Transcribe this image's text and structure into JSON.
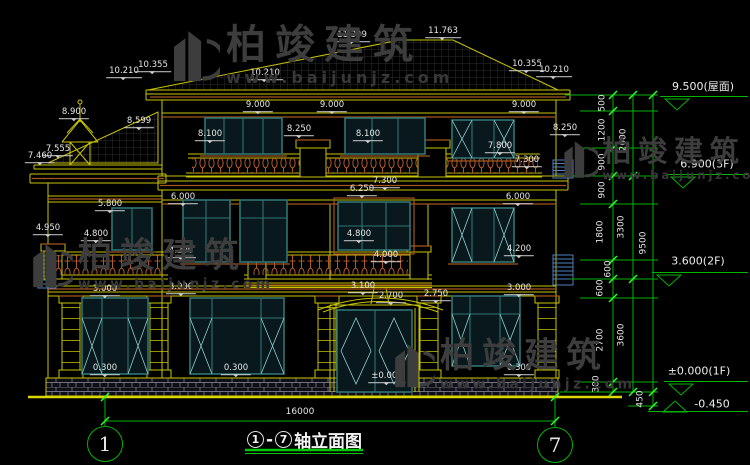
{
  "title_block": {
    "axis_start": "1",
    "separator": "-",
    "axis_end": "7",
    "title_text": "轴立面图",
    "span_dim": "16000"
  },
  "axis_bubbles": [
    {
      "label": "1",
      "x": 105,
      "y": 444
    },
    {
      "label": "7",
      "x": 555,
      "y": 445
    }
  ],
  "dim_labels": [
    {
      "t": "11.763",
      "x": 443,
      "y": 33
    },
    {
      "t": "11.399",
      "x": 352,
      "y": 37
    },
    {
      "t": "10.210",
      "x": 124,
      "y": 73
    },
    {
      "t": "10.355",
      "x": 153,
      "y": 67
    },
    {
      "t": "10.210",
      "x": 265,
      "y": 75
    },
    {
      "t": "10.355",
      "x": 527,
      "y": 66
    },
    {
      "t": "10.210",
      "x": 554,
      "y": 72
    },
    {
      "t": "8.900",
      "x": 74,
      "y": 114
    },
    {
      "t": "8.599",
      "x": 139,
      "y": 123
    },
    {
      "t": "9.000",
      "x": 258,
      "y": 107
    },
    {
      "t": "9.000",
      "x": 332,
      "y": 107
    },
    {
      "t": "9.000",
      "x": 524,
      "y": 107
    },
    {
      "t": "8.250",
      "x": 299,
      "y": 131
    },
    {
      "t": "8.100",
      "x": 210,
      "y": 136
    },
    {
      "t": "8.100",
      "x": 368,
      "y": 136
    },
    {
      "t": "8.250",
      "x": 565,
      "y": 130
    },
    {
      "t": "7.555",
      "x": 58,
      "y": 151
    },
    {
      "t": "7.460",
      "x": 40,
      "y": 158
    },
    {
      "t": "7.800",
      "x": 500,
      "y": 148
    },
    {
      "t": "7.300",
      "x": 527,
      "y": 162
    },
    {
      "t": "7.300",
      "x": 385,
      "y": 183
    },
    {
      "t": "6.250",
      "x": 362,
      "y": 191
    },
    {
      "t": "6.000",
      "x": 183,
      "y": 199
    },
    {
      "t": "6.000",
      "x": 518,
      "y": 199
    },
    {
      "t": "5.800",
      "x": 110,
      "y": 206
    },
    {
      "t": "4.950",
      "x": 48,
      "y": 230
    },
    {
      "t": "4.800",
      "x": 96,
      "y": 236
    },
    {
      "t": "4.800",
      "x": 359,
      "y": 236
    },
    {
      "t": "4.000",
      "x": 386,
      "y": 257
    },
    {
      "t": "4.200",
      "x": 181,
      "y": 253
    },
    {
      "t": "4.200",
      "x": 519,
      "y": 251
    },
    {
      "t": "3.000",
      "x": 181,
      "y": 289
    },
    {
      "t": "3.000",
      "x": 105,
      "y": 291
    },
    {
      "t": "3.000",
      "x": 519,
      "y": 290
    },
    {
      "t": "3.100",
      "x": 363,
      "y": 288
    },
    {
      "t": "2.700",
      "x": 391,
      "y": 298
    },
    {
      "t": "2.750",
      "x": 436,
      "y": 296
    },
    {
      "t": "0.300",
      "x": 105,
      "y": 370
    },
    {
      "t": "0.300",
      "x": 236,
      "y": 370
    },
    {
      "t": "0.300",
      "x": 519,
      "y": 370
    },
    {
      "t": "±0.000",
      "x": 387,
      "y": 378
    }
  ],
  "vert_dim_labels": [
    {
      "t": "500",
      "x": 603,
      "y": 103
    },
    {
      "t": "1200",
      "x": 603,
      "y": 130
    },
    {
      "t": "900",
      "x": 603,
      "y": 162
    },
    {
      "t": "900",
      "x": 603,
      "y": 190
    },
    {
      "t": "1800",
      "x": 601,
      "y": 232
    },
    {
      "t": "600",
      "x": 609,
      "y": 269
    },
    {
      "t": "600",
      "x": 601,
      "y": 288
    },
    {
      "t": "2700",
      "x": 601,
      "y": 340
    },
    {
      "t": "300",
      "x": 597,
      "y": 384
    },
    {
      "t": "450",
      "x": 641,
      "y": 399
    },
    {
      "t": "2600",
      "x": 624,
      "y": 140
    },
    {
      "t": "3300",
      "x": 622,
      "y": 227
    },
    {
      "t": "3600",
      "x": 622,
      "y": 335
    },
    {
      "t": "9500",
      "x": 644,
      "y": 243
    }
  ],
  "elev_markers": [
    {
      "text": "9.500(屋面)",
      "tx": 703,
      "ty": 86,
      "x1": 660,
      "x2": 748,
      "ly": 96,
      "trix": 664,
      "dir": "down"
    },
    {
      "text": "6.900(3F)",
      "tx": 707,
      "ty": 164,
      "x1": 666,
      "x2": 748,
      "ly": 174,
      "trix": 670,
      "dir": "down"
    },
    {
      "text": "3.600(2F)",
      "tx": 698,
      "ty": 261,
      "x1": 652,
      "x2": 748,
      "ly": 272,
      "trix": 656,
      "dir": "down"
    },
    {
      "text": "±0.000(1F)",
      "tx": 699,
      "ty": 371,
      "x1": 664,
      "x2": 748,
      "ly": 381,
      "trix": 668,
      "dir": "down"
    },
    {
      "text": "-0.450",
      "tx": 712,
      "ty": 404,
      "x1": 648,
      "x2": 748,
      "ly": 411,
      "trix": 662,
      "dir": "up"
    }
  ],
  "watermarks": [
    {
      "brand": "柏竣建筑",
      "url": "www.baijunjz.com",
      "x": 168,
      "y": 24,
      "scale": 1.0
    },
    {
      "brand": "柏竣建筑",
      "url": "www.baijunjz.com",
      "x": 560,
      "y": 136,
      "scale": 0.73
    },
    {
      "brand": "柏竣建筑",
      "url": "www.baijunjz.com",
      "x": 28,
      "y": 238,
      "scale": 0.86
    },
    {
      "brand": "柏竣建筑",
      "url": "www.baijunjz.com",
      "x": 390,
      "y": 338,
      "scale": 0.86
    }
  ],
  "colors": {
    "background": "#000000",
    "line_yellow": "#c9c500",
    "trim_orange": "#a4561e",
    "window_teal": "#2f7474",
    "glass_line": "#8fd0d0",
    "baluster_orange": "#b05a28",
    "dimension_green": "#00b400",
    "tick_green": "#2bff2b",
    "text_white": "#e6e6e6",
    "stone_gray": "#8c8ca0",
    "railing_blue": "#4d7fc0",
    "watermark_gray": "#3d3d3d"
  }
}
